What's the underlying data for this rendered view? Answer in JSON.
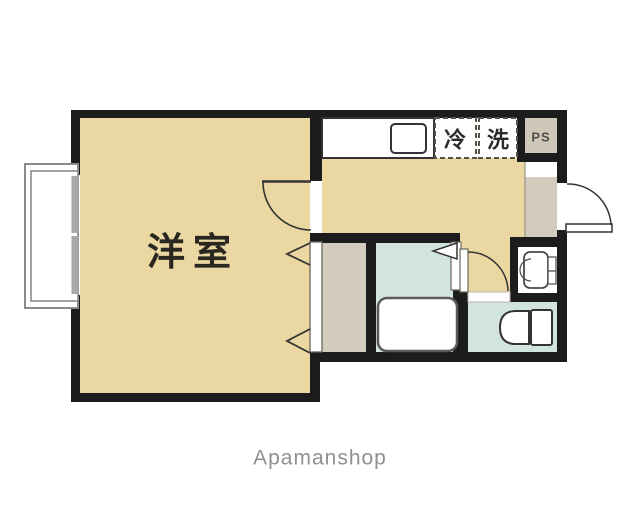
{
  "plan": {
    "title_note": "apartment floor plan",
    "rooms": {
      "western_room": {
        "label": "洋室",
        "fill": "#ebd7a2",
        "text_color": "#2a2620"
      },
      "kitchen_dk": {
        "fill": "#ebd7a2"
      },
      "corridor": {
        "fill": "#ebd7a2"
      },
      "closet": {
        "fill": "#d3ccbe"
      },
      "bathroom": {
        "fill": "#d2e4e0"
      },
      "toilet_room": {
        "fill": "#d2e4e0"
      },
      "entrance": {
        "fill": "#d3ccbe"
      },
      "pipe_space": {
        "label": "PS",
        "fill": "#cfc8b9",
        "text_color": "#4e4e4e"
      }
    },
    "appliance_spaces": {
      "refrigerator": {
        "label": "冷",
        "text_color": "#2a2a2a"
      },
      "washing_machine": {
        "label": "洗",
        "text_color": "#2a2a2a"
      }
    },
    "colors": {
      "wall": "#1c1c1c",
      "line": "#333333",
      "fixture_outline": "#4a4a4a",
      "dash_border": "#55524a",
      "window_frame": "#8a8a8a",
      "window_glass": "#a9a9a9",
      "boundary": "#9a9488"
    }
  },
  "footer": {
    "watermark": "Apamanshop",
    "color": "#8e9192"
  }
}
